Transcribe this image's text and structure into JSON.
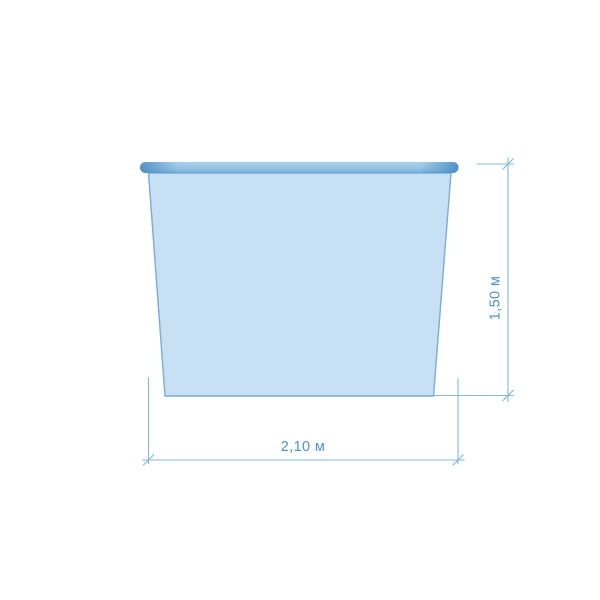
{
  "diagram": {
    "type": "dimension-drawing",
    "subject": "container-front-view-with-rim",
    "width_label": "2,10 м",
    "height_label": "1,50 м"
  },
  "colors": {
    "background": "#ffffff",
    "dimension_line": "#86b7df",
    "dimension_text": "#4d93cb",
    "body_fill": "#c7e0f3",
    "body_stroke": "#7aacd8",
    "rim_top": "#abd1ea",
    "rim_mid": "#8fc0e2",
    "rim_bottom": "#6ea7d4",
    "rim_edge": "#4a8bc5"
  }
}
